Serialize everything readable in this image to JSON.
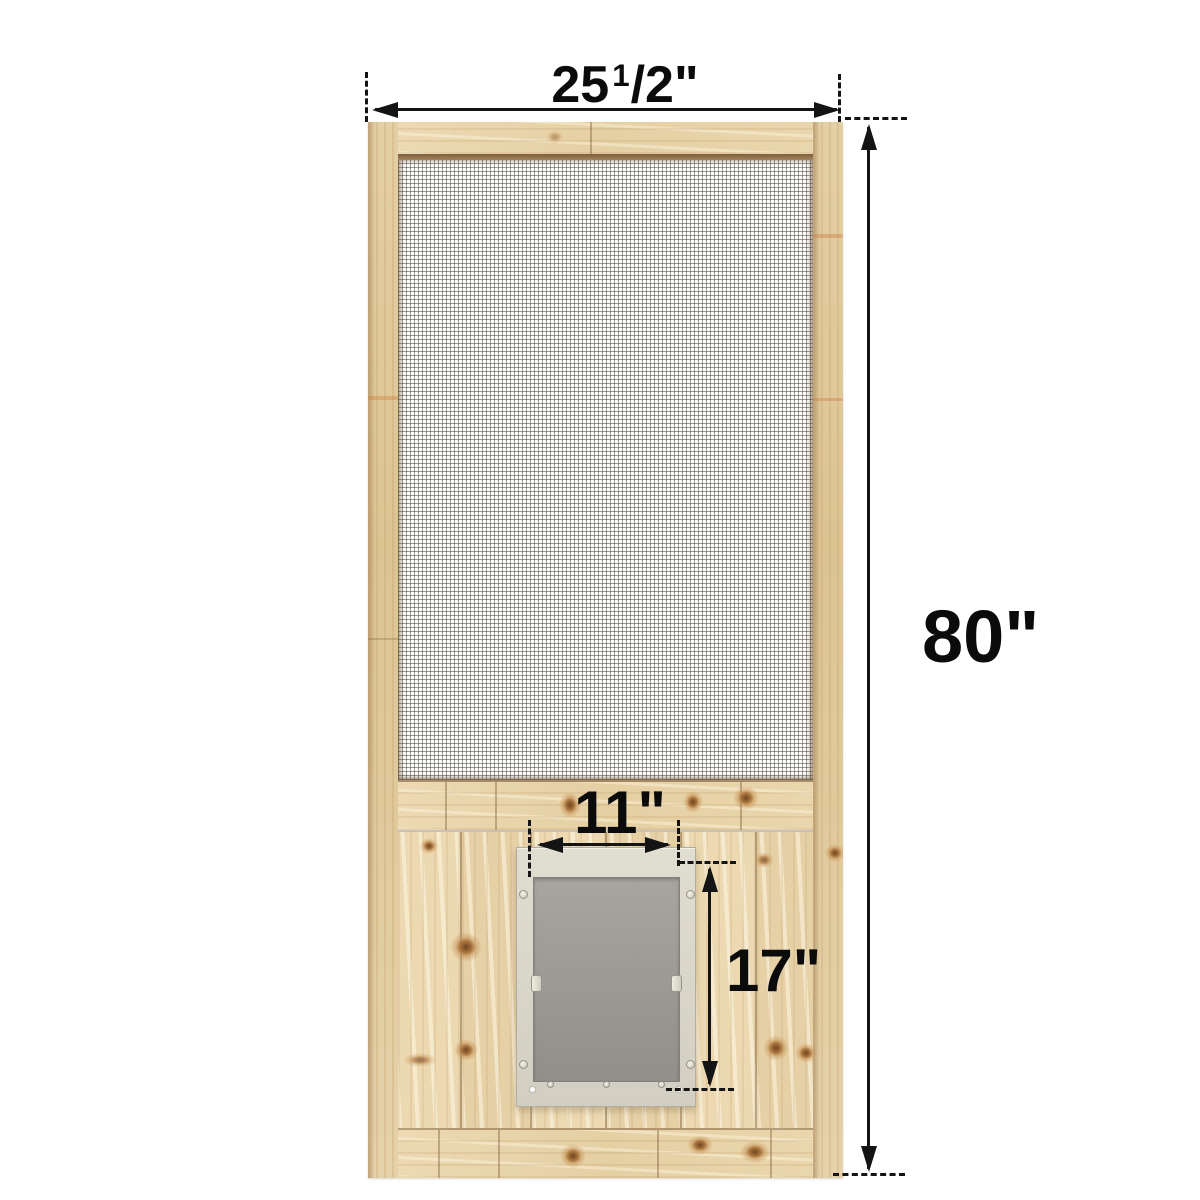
{
  "diagram": {
    "labels": {
      "overall_width": {
        "whole": "25",
        "sup": "1",
        "rest": "/2\""
      },
      "overall_height": "80\"",
      "pet_door_width": "11\"",
      "pet_door_height": "17\""
    },
    "colors": {
      "background": "#ffffff",
      "dimension_line": "#141414",
      "wood_base": "#e8d5ac",
      "wood_light": "#eedcb6",
      "wood_stile": "#e0cb9f",
      "wood_seam": "#7d5a34",
      "wood_knot": "#a9743c",
      "mesh_background": "#ffffff",
      "mesh_wire": "#4b4640",
      "pet_frame": "#dad7cb",
      "pet_flap": "#9e9c95"
    }
  }
}
